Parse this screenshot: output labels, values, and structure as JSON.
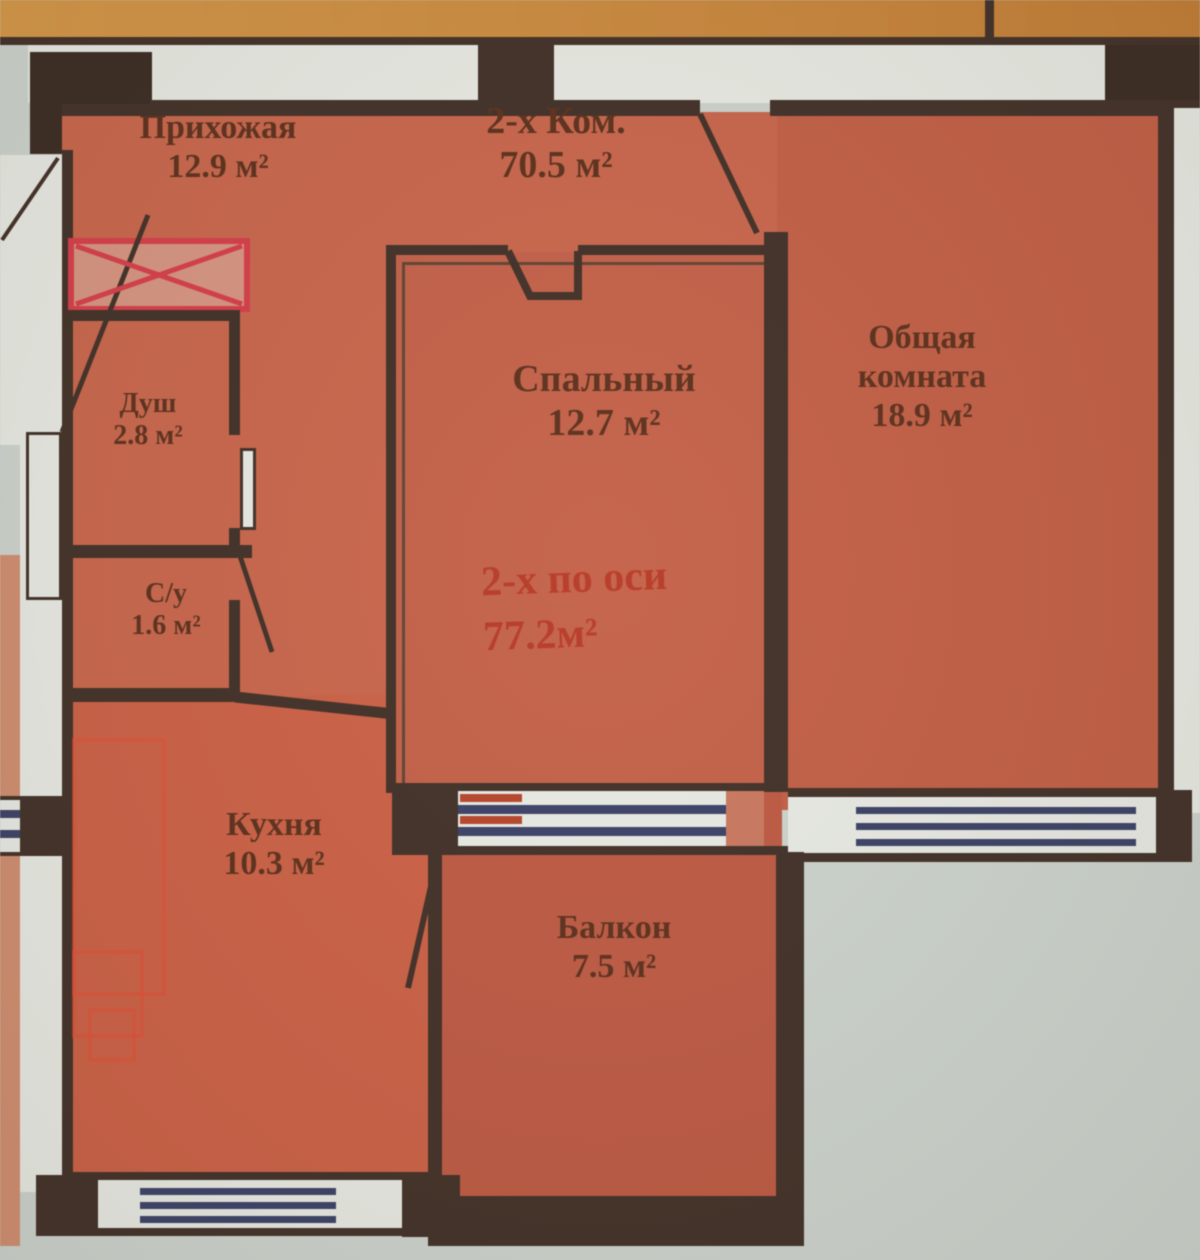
{
  "plan": {
    "apartment_title": {
      "name": "2-х Ком.",
      "area": "70.5 м²"
    },
    "rooms": {
      "hallway": {
        "name": "Прихожая",
        "area": "12.9 м²"
      },
      "shower": {
        "name": "Душ",
        "area": "2.8 м²"
      },
      "wc": {
        "name": "С/у",
        "area": "1.6 м²"
      },
      "bedroom": {
        "name": "Спальный",
        "area": "12.7 м²"
      },
      "living": {
        "name_line1": "Общая",
        "name_line2": "комната",
        "area": "18.9 м²"
      },
      "kitchen": {
        "name": "Кухня",
        "area": "10.3 м²"
      },
      "balcony": {
        "name": "Балкон",
        "area": "7.5 м²"
      }
    },
    "stamp": {
      "line1": "2-х по оси",
      "line2": "77.2м²"
    },
    "colors": {
      "room_fill": "#c8694f",
      "wall": "#44332a",
      "window_stripe": "#3e4468",
      "background": "#ced5cf",
      "adjacent_top_band": "#cf8f44",
      "adjacent_left_band": "#d09073",
      "wardrobe_red": "#d5414d",
      "stamp_red": "#b23622"
    }
  }
}
